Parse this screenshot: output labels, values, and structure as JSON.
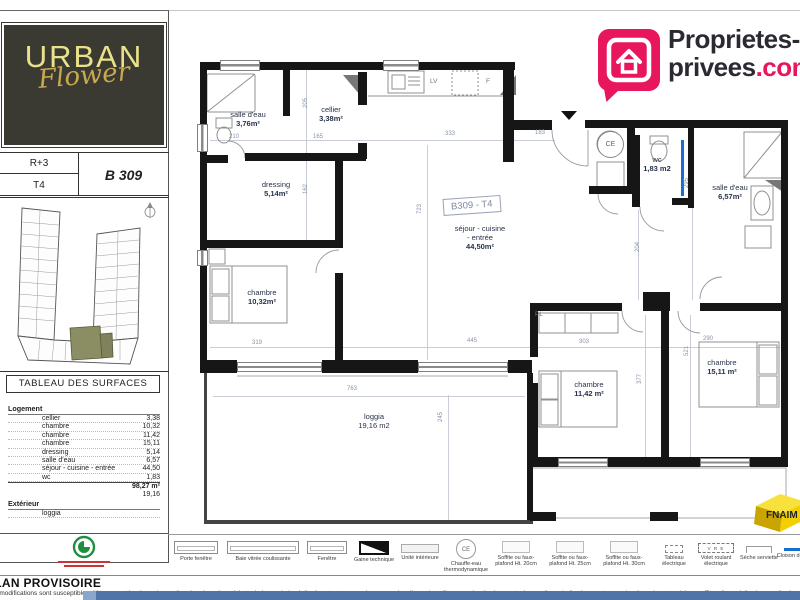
{
  "header": {
    "pp_logo": {
      "line1": "Proprietes-",
      "line2_dark": "privees",
      "line2_accent": ".com",
      "accent_color": "#e8175d"
    },
    "urban_logo": {
      "line1": "URBAN",
      "line2": "Flower"
    },
    "unit": {
      "floor": "R+3",
      "type": "T4",
      "number": "B 309"
    }
  },
  "surfaces": {
    "title": "TABLEAU DES SURFACES",
    "group1": "Logement",
    "rows": [
      {
        "label": "cellier",
        "value": "3,38"
      },
      {
        "label": "chambre",
        "value": "10,32"
      },
      {
        "label": "chambre",
        "value": "11,42"
      },
      {
        "label": "chambre",
        "value": "15,11"
      },
      {
        "label": "dressing",
        "value": "5,14"
      },
      {
        "label": "salle d'eau",
        "value": "6,57"
      },
      {
        "label": "séjour - cuisine - entrée",
        "value": "44,50"
      },
      {
        "label": "wc",
        "value": "1,83"
      }
    ],
    "total": "98,27 m²",
    "ext_value": "19,16",
    "group2": "Extérieur",
    "ext_row": "loggia"
  },
  "plan": {
    "tag": "B309 - T4",
    "rooms": [
      {
        "name": "salle d'eau",
        "area": "3,76m²"
      },
      {
        "name": "cellier",
        "area": "3,38m²"
      },
      {
        "name": "dressing",
        "area": "5,14m²"
      },
      {
        "name": "séjour - cuisine",
        "name2": "- entrée",
        "area": "44,50m²"
      },
      {
        "name": "chambre",
        "area": "10,32m²"
      },
      {
        "name": "wc",
        "area": "1,83 m2"
      },
      {
        "name": "salle d'eau",
        "area": "6,57m²"
      },
      {
        "name": "chambre",
        "area": "11,42 m²"
      },
      {
        "name": "chambre",
        "area": "15,11 m²"
      },
      {
        "name": "loggia",
        "area": "19,16 m2"
      }
    ],
    "dims": [
      "210",
      "165",
      "205",
      "162",
      "333",
      "183",
      "723",
      "319",
      "445",
      "763",
      "245",
      "303",
      "290",
      "377",
      "521",
      "295",
      "204"
    ],
    "kitchen_lv": "LV",
    "kitchen_f": "F",
    "ce": "CE",
    "pl": "PL"
  },
  "legend": {
    "items": [
      "Porte fenêtre",
      "Baie vitrée coulissante",
      "Fenêtre",
      "Gaine technique",
      "Unité intérieure",
      "Chauffe-eau thermodynamique",
      "Soffite ou faux-plafond Ht. 20cm",
      "Soffite ou faux-plafond Ht. 25cm",
      "Soffite ou faux-plafond Ht. 30cm",
      "Tableau électrique",
      "Volet roulant électrique",
      "Sèche serviette",
      "Cloison démontable"
    ],
    "vre": "V R E",
    "ce": "CE"
  },
  "footer": {
    "title": "PLAN PROVISOIRE",
    "disclaimer": "Des modifications sont susceptibles d'être apportées à ce plan en fonction des nécessités techniques de la réalisation, tant en ce qui concerne les dimensions libres que les équipements. Les surfaces indiquées sont approximatives, les retombées, soffites, faux-plafonds, canalisations sont figurés à titre indicatif."
  },
  "branding": {
    "fnaim": "FNAIM"
  }
}
